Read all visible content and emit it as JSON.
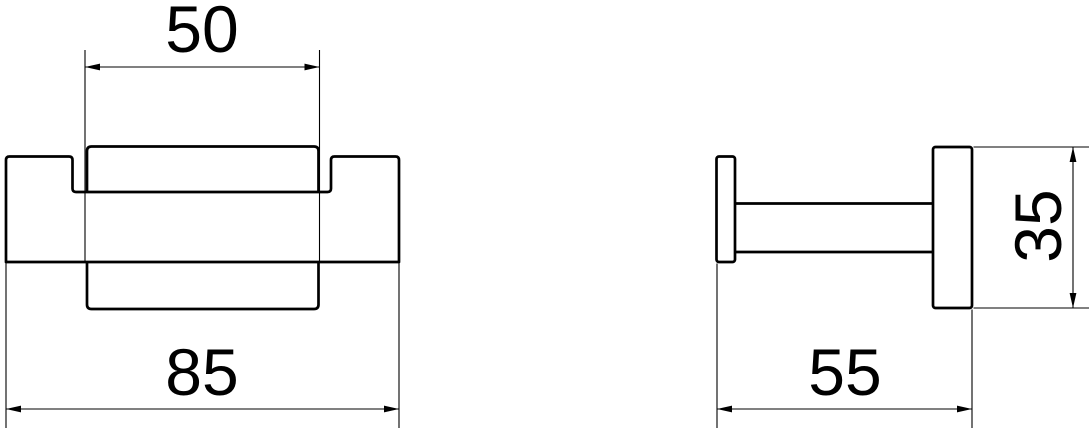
{
  "colors": {
    "background": "#ffffff",
    "line": "#000000"
  },
  "front_view": {
    "top_dimension": "50",
    "bottom_dimension": "85"
  },
  "side_view": {
    "bottom_dimension": "55",
    "right_dimension": "35"
  }
}
